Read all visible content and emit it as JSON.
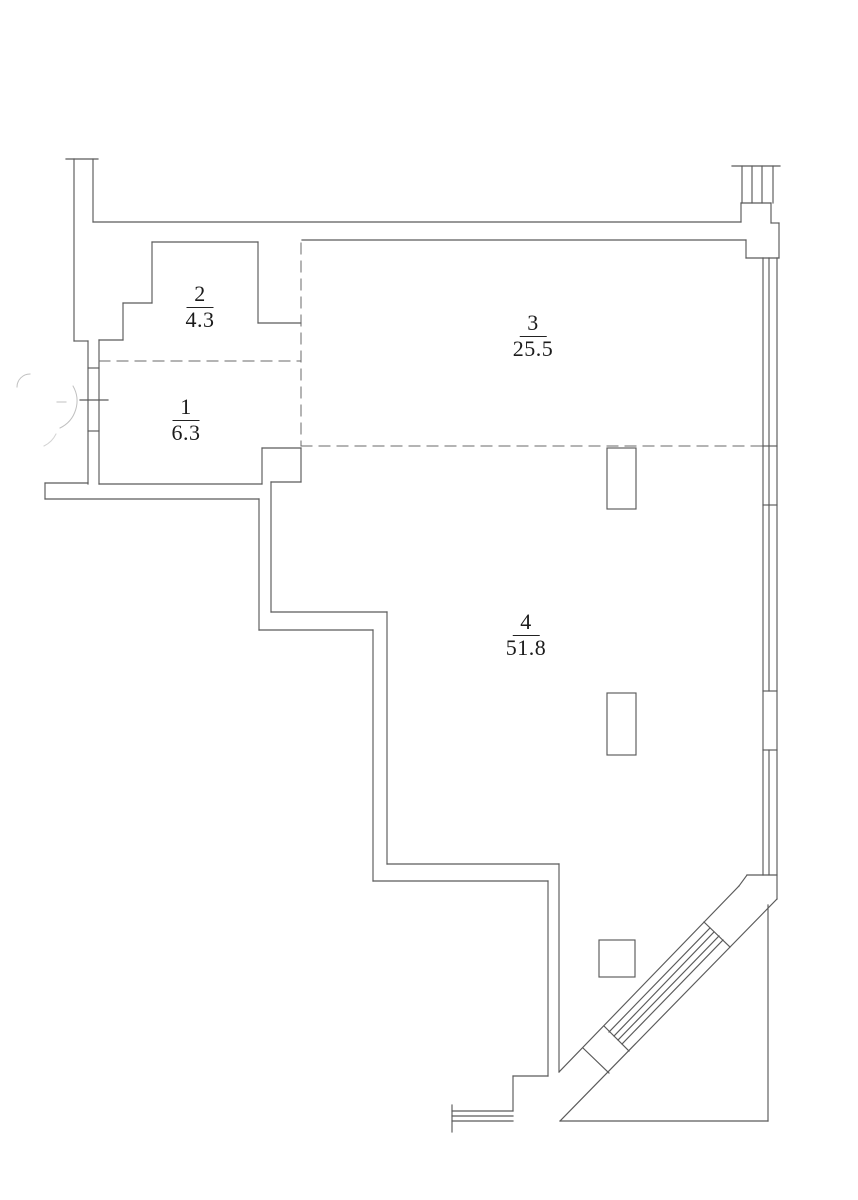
{
  "title": "Apartment floor plan",
  "rooms": [
    {
      "number": "1",
      "area": "6.3"
    },
    {
      "number": "2",
      "area": "4.3"
    },
    {
      "number": "3",
      "area": "25.5"
    },
    {
      "number": "4",
      "area": "51.8"
    }
  ],
  "colors": {
    "background": "#ffffff",
    "wall_line": "#5a5a5a",
    "dashed_line": "#6a6a6a",
    "faint_line": "#c0c0c0",
    "text": "#1b1b1b"
  }
}
